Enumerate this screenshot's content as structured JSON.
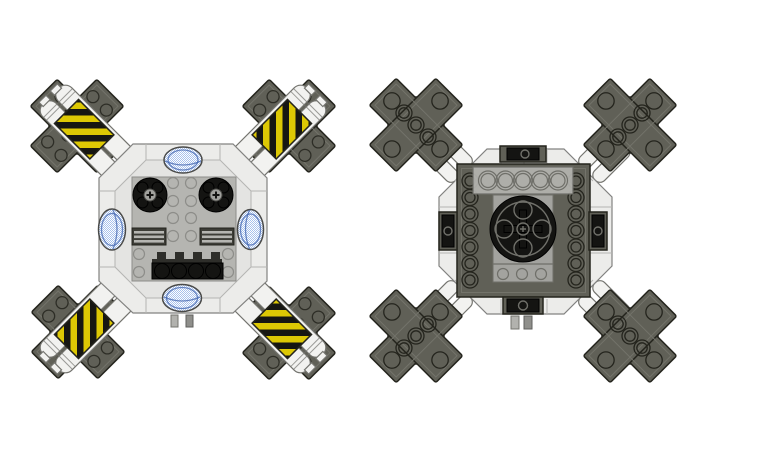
{
  "canvas": {
    "width": 773,
    "height": 461,
    "background": "#ffffff"
  },
  "scene": {
    "title": "LEGO-style modular pod rendered in two orthographic views",
    "views": [
      {
        "id": "left",
        "label": "Top view",
        "description": "Light gray octagonal pod with four dark olive X-shaped bumper arms attached by white tanks wrapped in yellow-black hazard stripes; four transparent blue oval domes; two black rotor discs with axle crosses; two grille vents; black four-stud strip with battlement plate; two pins on the bottom edge."
      },
      {
        "id": "right",
        "label": "Bottom view",
        "description": "Underside of the same pod: white plate ring, dark olive frame with open anti-stud tubes, central black turntable with cross-axle hub, translucent gray plate with five tubes, pin-hole bricks on each edge, and white hinge connectors leading to the four arms."
      }
    ]
  },
  "colors": {
    "background": "#ffffff",
    "ring_white": "#ececea",
    "body_inner": "#e4e4e2",
    "outline_gray": "#828280",
    "seam_gray": "#b5b5b3",
    "plate_gray": "#b5b5b1",
    "plate_line": "#8d8d89",
    "olive": "#606057",
    "olive_outline": "#24241d",
    "olive_inner": "#73736a",
    "black_part": "#141412",
    "detail_line": "#70706a",
    "white_part": "#f2f2f0",
    "cyl_line": "#74746f",
    "mid_gray": "#a3a39f",
    "mid_line": "#6f6f69",
    "dome_blue": "#a9c2ec",
    "dome_blue_dark": "#4064b0",
    "hazard_yellow": "#ddc804",
    "hazard_black": "#161612",
    "crenel_gray": "#2e2e2a",
    "grille_dark": "#3d3d37",
    "tab_light": "#b2b2ae",
    "tab_dark": "#8f8f8b"
  },
  "parts": {
    "left_view": {
      "corner_arms": 4,
      "hazard_tanks": 4,
      "blue_domes": 4,
      "rotor_discs": 2,
      "grille_vents": 2,
      "stud_strip_studs": 4,
      "bottom_pins": 2
    },
    "right_view": {
      "corner_arms": 4,
      "hinge_connectors": 4,
      "tube_columns": 2,
      "tube_plate_circles": 5,
      "turntable": 1,
      "pin_hole_bricks": 4,
      "bottom_pins": 2
    }
  }
}
